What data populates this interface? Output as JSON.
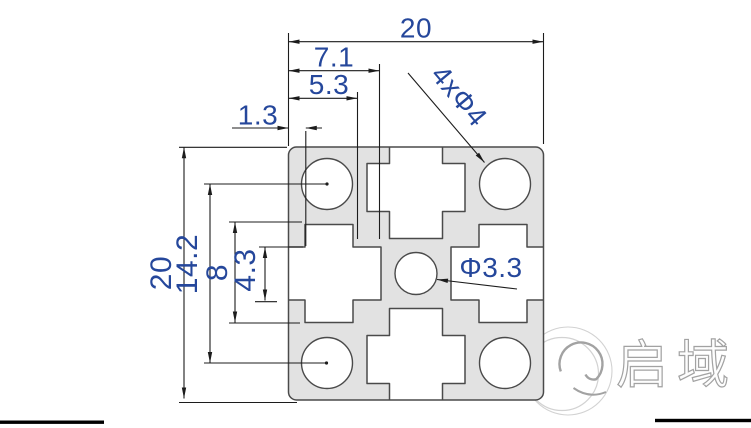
{
  "dimensions": {
    "overall_width": "20",
    "slot_offset": "7.1",
    "cavity_offset": "5.3",
    "lip_thickness": "1.3",
    "corner_holes_label": "4xΦ4",
    "overall_height": "20",
    "hole_spacing": "14.2",
    "slot_cavity_width": "8",
    "slot_opening_width": "4.3",
    "center_hole_label": "Φ3.3"
  },
  "watermark": {
    "brand_text": "启域"
  },
  "colors": {
    "profile_fill": "#e2e2e2",
    "profile_stroke": "#4a4a4a",
    "dim_line": "#1c1c1c",
    "dim_text": "#25479b",
    "watermark_stroke": "#a2a2a2",
    "watermark_faint": "#d2d2d2",
    "frame": "#000000"
  }
}
